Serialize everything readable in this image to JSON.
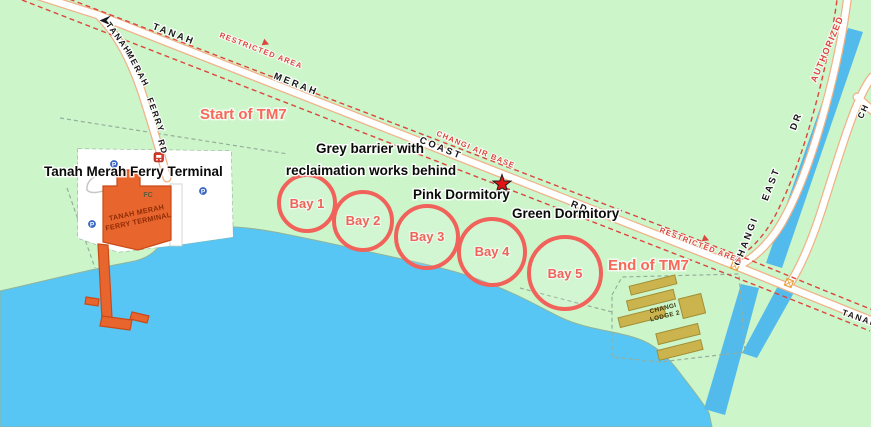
{
  "colors": {
    "land": "#CCF5CA",
    "water": "#57C6F5",
    "canal": "#53BBEC",
    "road_fill": "#FFFFFF",
    "road_casing": "#F0B287",
    "restricted_red": "#DE453E",
    "annotation_red": "#F9695B",
    "bay_red": "#F0625A",
    "terminal_orange": "#E8662E",
    "lodge_khaki": "#CBB44D",
    "boundary_dash": "#96AE9B"
  },
  "annotations": {
    "ferry_terminal": "Tanah Merah Ferry Terminal",
    "barrier_line1": "Grey barrier with",
    "barrier_line2": "reclaimation works behind",
    "pink_dormitory": "Pink Dormitory",
    "green_dormitory": "Green Dormitory",
    "start_tm7": "Start of TM7",
    "end_tm7": "End of TM7"
  },
  "bays": [
    {
      "label": "Bay 1"
    },
    {
      "label": "Bay 2"
    },
    {
      "label": "Bay 3"
    },
    {
      "label": "Bay 4"
    },
    {
      "label": "Bay 5"
    }
  ],
  "roads": {
    "coast": {
      "word1": "TANAH",
      "word2": "MERAH",
      "word3": "COAST",
      "word4": "RD"
    },
    "ferry": {
      "word1": "TANAH",
      "word2": "MERAH",
      "word3": "FERRY",
      "word4": "RD"
    },
    "changi_east": {
      "word1": "CHANGI",
      "word2": "EAST",
      "word3": "DR"
    },
    "edge": {
      "ch": "CH",
      "tanah": "TANAH"
    }
  },
  "restricted": {
    "area1": "RESTRICTED AREA",
    "area2": "RESTRICTED AREA",
    "airbase": "CHANGI AIR BASE",
    "authorized": "AUTHORIZED"
  },
  "places": {
    "terminal_line1": "TANAH MERAH",
    "terminal_line2": "FERRY TERMINAL",
    "fc": "FC",
    "lodge_line1": "CHANGI",
    "lodge_line2": "LODGE 2",
    "parking": "P"
  }
}
